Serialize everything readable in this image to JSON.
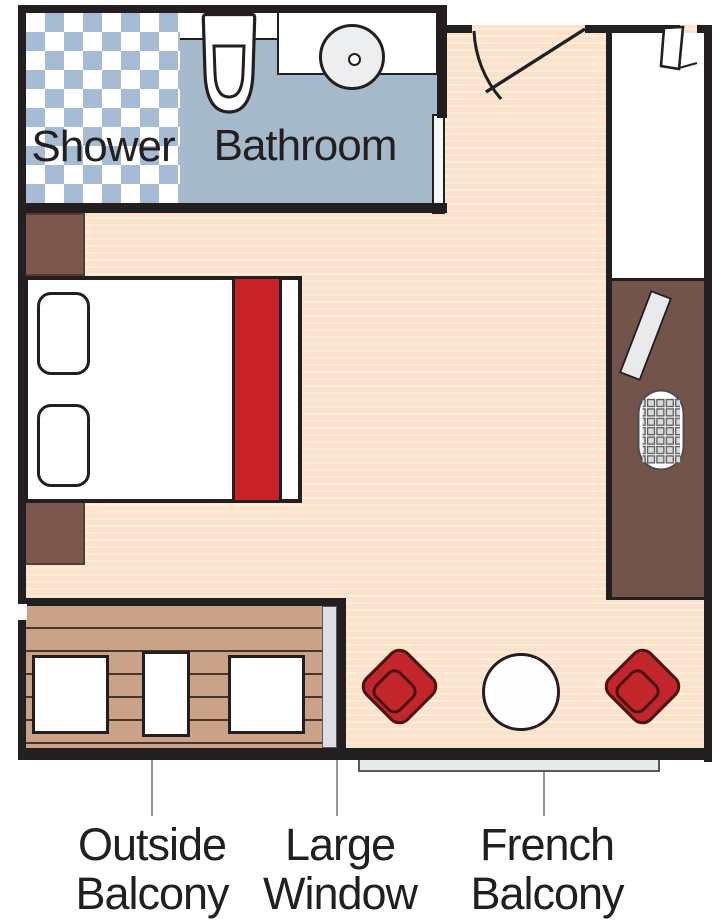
{
  "plan": {
    "rooms": {
      "shower": {
        "label": "Shower"
      },
      "bathroom": {
        "label": "Bathroom"
      }
    },
    "callouts": {
      "outside_balcony": {
        "line1": "Outside",
        "line2": "Balcony"
      },
      "large_window": {
        "line1": "Large",
        "line2": "Window"
      },
      "french_balcony": {
        "line1": "French",
        "line2": "Balcony"
      }
    },
    "colors": {
      "wall": "#231f20",
      "cabin_floor": "#fbe2ca",
      "bathroom_floor": "#a4b9c9",
      "shower_tile_blue": "#a5bcd4",
      "wood_cabinet": "#7d574c",
      "desk_unit": "#72544b",
      "deck_wood": "#c9a288",
      "accent_red": "#c2262b",
      "bed_runner_red": "#c92127",
      "window_glass": "#dcdee1",
      "railing_gray": "#e8e9ea",
      "leader_line": "#939598",
      "label_text": "#231f20"
    }
  }
}
